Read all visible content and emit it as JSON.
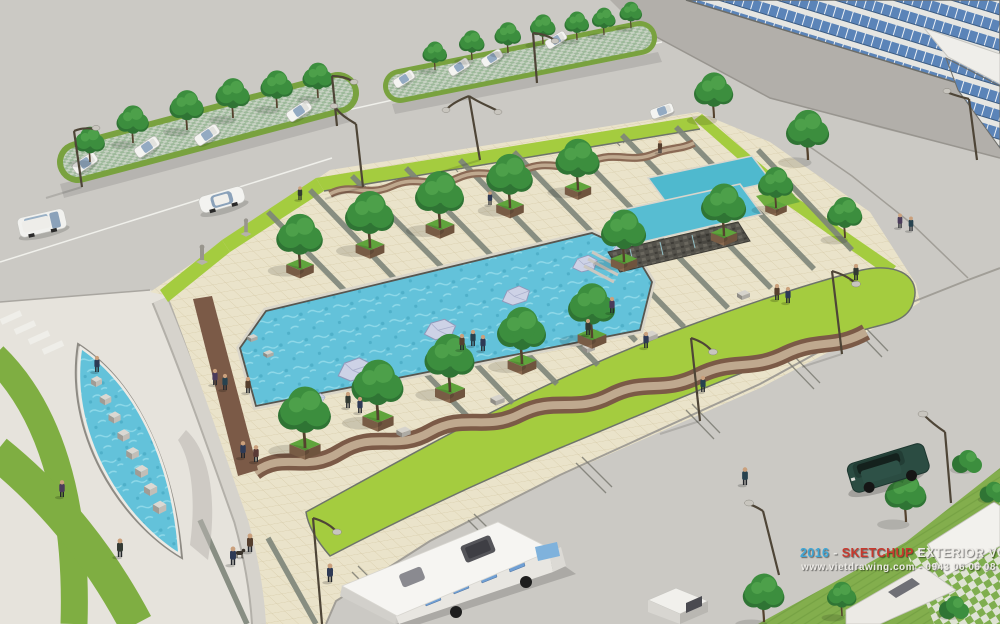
{
  "meta": {
    "kind": "sketchup-style 3d architectural rendering",
    "subject": "aerial view of an urban landscape plaza with linear water pools, tree planters, serpentine paved paths, an eye-shaped fountain with stepping stones, tree-lined parking medians, surrounding roads, a glass curtain-wall building, a white bus and a dark green SUV"
  },
  "watermark": {
    "year": "2016",
    "sep": " - ",
    "brand": "SKETCHUP",
    "series": " EXTERIOR VOL.16",
    "line2": "www.vietdrawing.com - 0943 06 06 08"
  },
  "palette": {
    "road": "#cbc9c4",
    "dark_road": "#b2afaa",
    "paving_cream": "#eae3ca",
    "paving_grid": "#d6caa8",
    "grass_bright": "#a4cc3f",
    "grass_median": "#79a23f",
    "lawn": "#83ae4d",
    "water": "#63c2da",
    "water_raised": "#4fb9ce",
    "island_stone": "#cdd2e6",
    "path_brown": "#7b5a47",
    "path_tan": "#bfa98f",
    "tree_green": "#3c8e3e",
    "glass_blue": "#5b84b8",
    "stone_wall": "#54524b",
    "suv_green": "#2b4c42",
    "bus_white": "#f6f5f2"
  },
  "scene": {
    "regions": [
      "parking-median-north-west",
      "parking-median-north",
      "glass-building-north-east",
      "central-plaza",
      "linear-water-pool",
      "raised-cascade-basins",
      "eye-shaped-fountain",
      "concentric-grass-arcs",
      "south-lawn-corner",
      "roads"
    ]
  }
}
